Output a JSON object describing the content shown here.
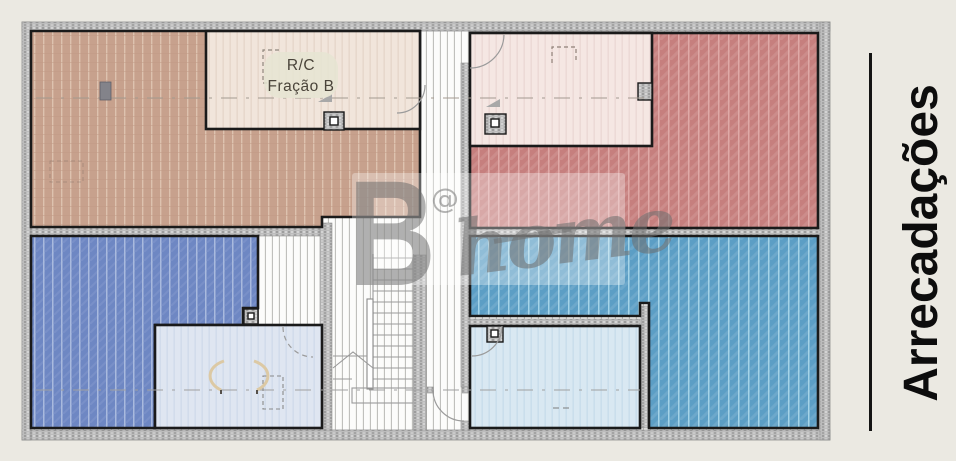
{
  "canvas": {
    "width": 956,
    "height": 461,
    "background": "#ebe9e2"
  },
  "plan": {
    "room_label": {
      "line1": "R/C",
      "line2": "Fração B"
    },
    "palette": {
      "storage_top_left": "#c7a18d",
      "room_rc_fracao_b": "#f1e5db",
      "room_top_middle_right": "#f5e7e3",
      "storage_top_right": "#c67f7e",
      "storage_bottom_left": "#6e87c3",
      "room_bottom_middle_left": "#dfe6f1",
      "room_bottom_middle_right": "#d9e8f2",
      "storage_bottom_right": "#5c9ec5",
      "inner_wall": "#1a1a1a",
      "outer_wall": "#bcbcbc",
      "corridor_floor": "#fcfcfb"
    }
  },
  "watermark": {
    "letter_b": "B",
    "at_sign": "@",
    "word_home": "home"
  },
  "side_panel": {
    "title": "Arrecadações"
  }
}
